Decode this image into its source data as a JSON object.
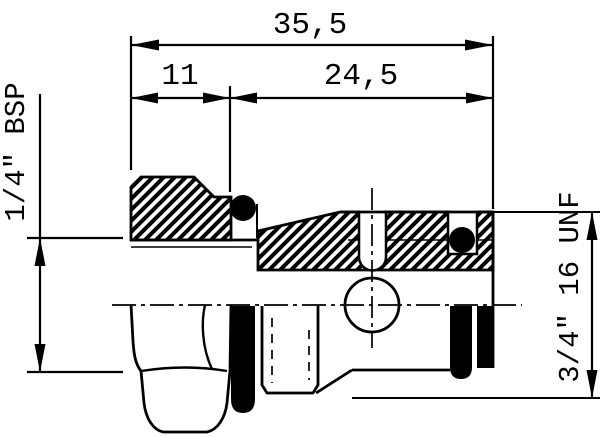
{
  "drawing": {
    "type": "engineering-cross-section",
    "background": "#ffffff",
    "line_color": "#000000",
    "dimensions": {
      "total_length": "35,5",
      "hex_length": "11",
      "thread_length": "24,5",
      "left_thread_label": "1/4\" BSP",
      "right_thread_label": "3/4\" 16 UNF"
    }
  }
}
